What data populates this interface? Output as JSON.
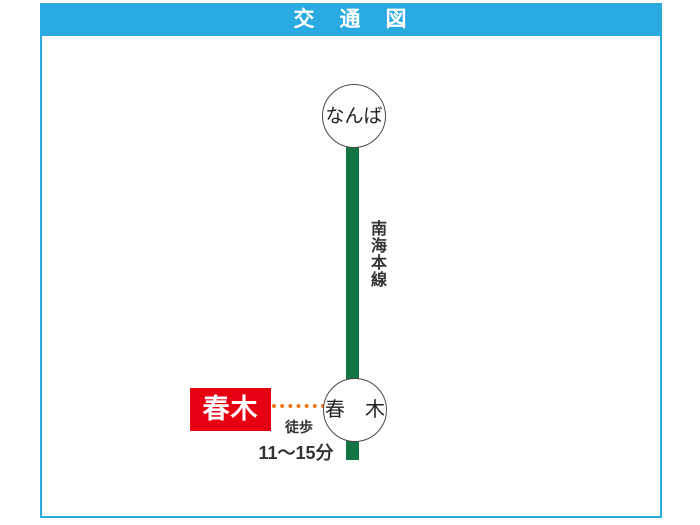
{
  "header": {
    "title": "交　通　図",
    "bg_color": "#29abe2",
    "text_color": "#ffffff"
  },
  "frame": {
    "border_color": "#29abe2"
  },
  "diagram": {
    "rail_line": {
      "name": "南海本線",
      "color": "#127442"
    },
    "stations": [
      {
        "label": "なんば"
      },
      {
        "label": "春　木"
      }
    ],
    "property_box": {
      "label": "春木",
      "bg_color": "#e60012",
      "text_color": "#ffffff"
    },
    "walk": {
      "mode": "徒歩",
      "duration": "11〜15分",
      "dots_color": "#ed781e"
    }
  }
}
